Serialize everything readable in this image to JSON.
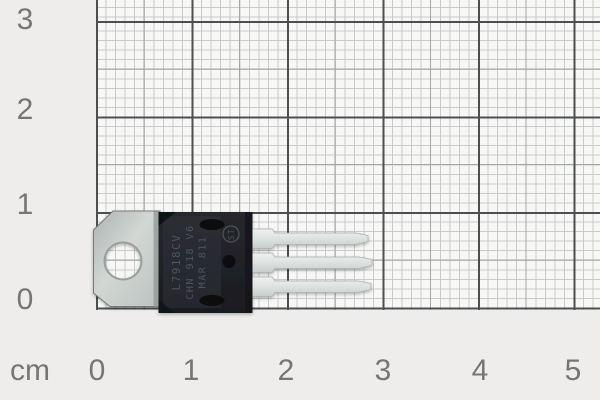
{
  "scene": {
    "description": "TO-220 package voltage regulator photographed lying on millimeter graph paper with centimeter ruler markings",
    "pixels_per_cm": 95.5
  },
  "ruler": {
    "unit_label": "cm",
    "bottom_ticks": [
      "0",
      "1",
      "2",
      "3",
      "4",
      "5"
    ],
    "left_ticks": [
      "3",
      "2",
      "1",
      "0"
    ]
  },
  "component": {
    "package": "TO-220",
    "lead_count": "3",
    "marking_line1": "L7918CV",
    "marking_line2": "CHN 918 V6",
    "marking_line3": "MAR 811",
    "logo_text": "ST"
  },
  "colors": {
    "margin_bg": "#eeedeb",
    "paper_bg": "#f7f7f5",
    "grid_minor": "#c9cbca",
    "grid_medium": "#a3a6a5",
    "grid_major": "#4c4f4f",
    "ruler_text": "#767676",
    "body_black": "#1f2126",
    "tab_silver": "#c7cccา9",
    "lead_silver": "#dde2e0",
    "marking_gray": "#4e545b"
  }
}
